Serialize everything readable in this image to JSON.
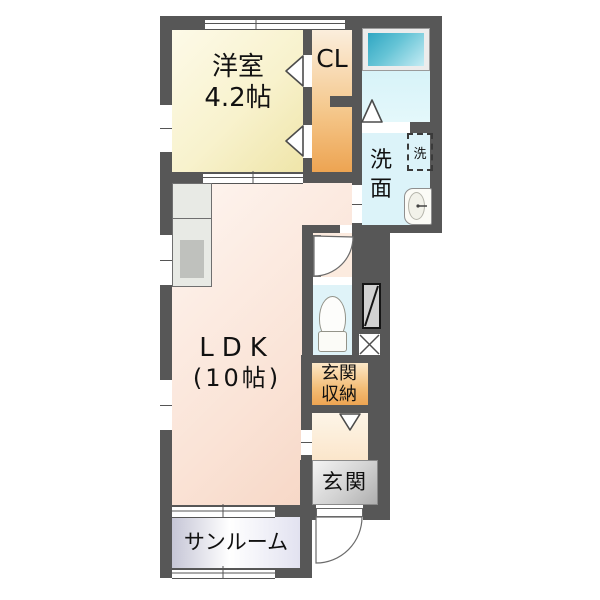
{
  "plan": {
    "title": "1LDK floor plan",
    "rooms": {
      "western_room": {
        "name": "洋室",
        "size": "4.2帖"
      },
      "closet": {
        "label": "CL"
      },
      "ldk": {
        "name": "LDK",
        "size": "(10帖)"
      },
      "washroom": {
        "label": "洗面"
      },
      "washer_space": {
        "label": "洗"
      },
      "entrance_storage": {
        "line1": "玄関",
        "line2": "収納"
      },
      "entrance": {
        "label": "玄関"
      },
      "sunroom": {
        "label": "サンルーム"
      }
    },
    "colors": {
      "wall": "#575757",
      "western_room": "#f4ecba",
      "closet": "#efad5c",
      "ldk": "#f8dccd",
      "bath_floor": "#dff5f9",
      "bathtub": "#3fb0c9",
      "washroom_floor": "#dcf3f9",
      "toilet_floor": "#dff3f8",
      "entrance_storage": "#eda452",
      "entrance_floor": "#bdbdbd",
      "sunroom_floor": "#dcdcec",
      "hall_floor": "#fcecd8",
      "kitchen_counter": "#e8eae5"
    }
  }
}
